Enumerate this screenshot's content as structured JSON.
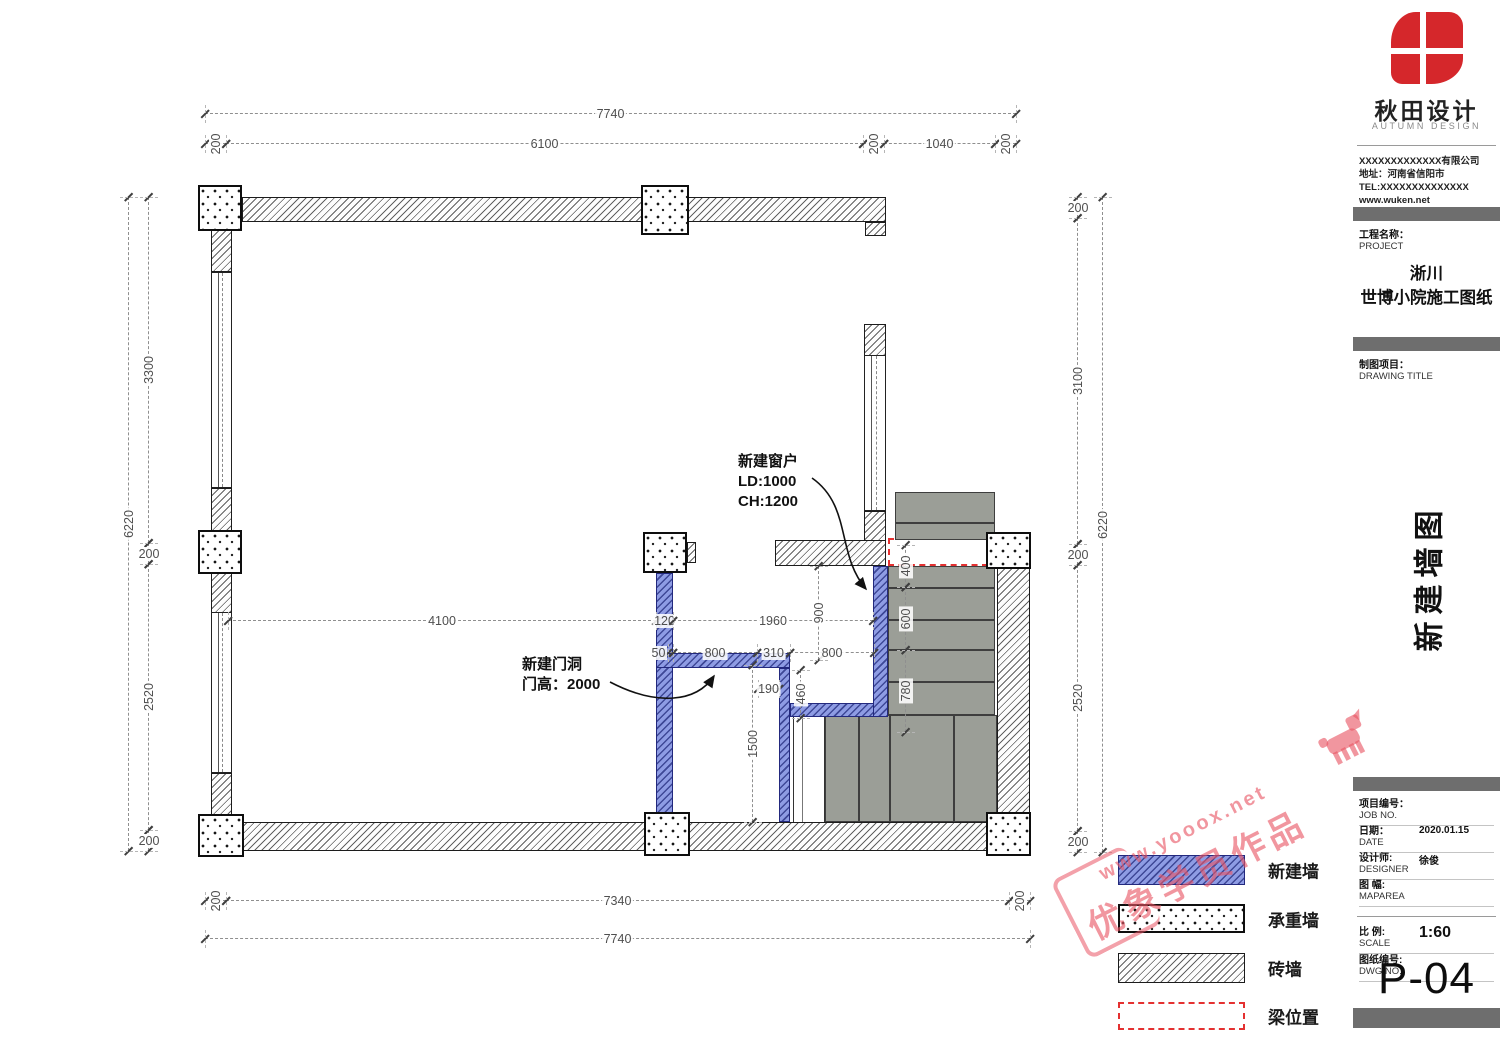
{
  "titleblock": {
    "brand": {
      "name_cn": "秋田设计",
      "name_en": "AUTUMN DESIGN",
      "company": "XXXXXXXXXXXXX有限公司",
      "address": "地址：河南省信阳市",
      "tel": "TEL:XXXXXXXXXXXXXX",
      "web": "www.wuken.net"
    },
    "project_label_cn": "工程名称：",
    "project_label_en": "PROJECT",
    "project_name_line1": "淅川",
    "project_name_line2": "世博小院施工图纸",
    "drawing_label_cn": "制图项目：",
    "drawing_label_en": "DRAWING TITLE",
    "drawing_title": "新建墙图",
    "meta": [
      {
        "cn": "项目编号：",
        "en": "JOB NO.",
        "value": "",
        "y": 792
      },
      {
        "cn": "日期：",
        "en": "DATE",
        "value": "2020.01.15",
        "y": 819
      },
      {
        "cn": "设计师:",
        "en": "DESIGNER",
        "value": "徐俊",
        "y": 846
      },
      {
        "cn": "图 幅:",
        "en": "MAPAREA",
        "value": "",
        "y": 873
      },
      {
        "cn": "比 例:",
        "en": "SCALE",
        "value": "1:60",
        "y": 920,
        "big": true
      },
      {
        "cn": "图纸编号:",
        "en": "DWG NO.",
        "value": "",
        "y": 948
      }
    ],
    "sheet_number": "P-04"
  },
  "legend": {
    "items": [
      {
        "label": "新建墙",
        "type": "blue",
        "y": 855,
        "h": 30
      },
      {
        "label": "承重墙",
        "type": "stipple",
        "y": 904,
        "h": 29
      },
      {
        "label": "砖墙",
        "type": "hatch",
        "y": 953,
        "h": 30
      },
      {
        "label": "梁位置",
        "type": "beam",
        "y": 1002,
        "h": 28
      }
    ]
  },
  "notes": [
    {
      "lines": [
        "新建窗户",
        "LD:1000",
        "CH:1200"
      ],
      "x": 738,
      "y": 452
    },
    {
      "lines": [
        "新建门洞",
        "门高：2000"
      ],
      "x": 522,
      "y": 655
    }
  ],
  "dimensions": [
    {
      "o": "h",
      "x": 205,
      "y": 113,
      "len": 811,
      "label": "7740"
    },
    {
      "o": "h",
      "x": 205,
      "y": 143,
      "len": 21,
      "label": "200",
      "rot": 1
    },
    {
      "o": "h",
      "x": 226,
      "y": 143,
      "len": 637,
      "label": "6100"
    },
    {
      "o": "h",
      "x": 863,
      "y": 143,
      "len": 21,
      "label": "200",
      "rot": 1
    },
    {
      "o": "h",
      "x": 884,
      "y": 143,
      "len": 111,
      "label": "1040"
    },
    {
      "o": "h",
      "x": 995,
      "y": 143,
      "len": 21,
      "label": "200",
      "rot": 1
    },
    {
      "o": "h",
      "x": 205,
      "y": 900,
      "len": 21,
      "label": "200",
      "rot": 1
    },
    {
      "o": "h",
      "x": 226,
      "y": 900,
      "len": 783,
      "label": "7340"
    },
    {
      "o": "h",
      "x": 1009,
      "y": 900,
      "len": 21,
      "label": "200",
      "rot": 1
    },
    {
      "o": "h",
      "x": 205,
      "y": 938,
      "len": 825,
      "label": "7740"
    },
    {
      "o": "v",
      "x": 128,
      "y": 197,
      "len": 654,
      "label": "6220",
      "rot": 1
    },
    {
      "o": "v",
      "x": 148,
      "y": 197,
      "len": 346,
      "label": "3300",
      "rot": 1
    },
    {
      "o": "v",
      "x": 148,
      "y": 543,
      "len": 21,
      "label": "200"
    },
    {
      "o": "v",
      "x": 148,
      "y": 564,
      "len": 266,
      "label": "2520",
      "rot": 1
    },
    {
      "o": "v",
      "x": 148,
      "y": 830,
      "len": 21,
      "label": "200"
    },
    {
      "o": "v",
      "x": 1077,
      "y": 197,
      "len": 21,
      "label": "200"
    },
    {
      "o": "v",
      "x": 1077,
      "y": 218,
      "len": 326,
      "label": "3100",
      "rot": 1
    },
    {
      "o": "v",
      "x": 1077,
      "y": 544,
      "len": 21,
      "label": "200"
    },
    {
      "o": "v",
      "x": 1077,
      "y": 565,
      "len": 266,
      "label": "2520",
      "rot": 1
    },
    {
      "o": "v",
      "x": 1077,
      "y": 831,
      "len": 21,
      "label": "200"
    },
    {
      "o": "v",
      "x": 1102,
      "y": 197,
      "len": 655,
      "label": "6220",
      "rot": 1
    },
    {
      "o": "h",
      "x": 228,
      "y": 620,
      "len": 428,
      "label": "4100"
    },
    {
      "o": "h",
      "x": 656,
      "y": 620,
      "len": 17,
      "label": "120"
    },
    {
      "o": "h",
      "x": 673,
      "y": 620,
      "len": 200,
      "label": "1960"
    },
    {
      "o": "v",
      "x": 818,
      "y": 566,
      "len": 94,
      "label": "900",
      "rot": 1
    },
    {
      "o": "h",
      "x": 668,
      "y": 652,
      "len": 5,
      "label": "50",
      "dx": -12
    },
    {
      "o": "h",
      "x": 673,
      "y": 652,
      "len": 84,
      "label": "800"
    },
    {
      "o": "h",
      "x": 757,
      "y": 652,
      "len": 33,
      "label": "310"
    },
    {
      "o": "h",
      "x": 790,
      "y": 652,
      "len": 84,
      "label": "800"
    },
    {
      "o": "v",
      "x": 800,
      "y": 670,
      "len": 48,
      "label": "460",
      "rot": 1
    },
    {
      "o": "h",
      "x": 758,
      "y": 688,
      "len": 21,
      "label": "190"
    },
    {
      "o": "v",
      "x": 752,
      "y": 665,
      "len": 157,
      "label": "1500",
      "rot": 1
    },
    {
      "o": "v",
      "x": 905,
      "y": 545,
      "len": 42,
      "label": "400",
      "rot": 1
    },
    {
      "o": "v",
      "x": 905,
      "y": 587,
      "len": 63,
      "label": "600",
      "rot": 1
    },
    {
      "o": "v",
      "x": 905,
      "y": 650,
      "len": 82,
      "label": "780",
      "rot": 1
    }
  ],
  "watermark": {
    "line1": "www.yooox.net",
    "line2": "优象学员作品"
  }
}
